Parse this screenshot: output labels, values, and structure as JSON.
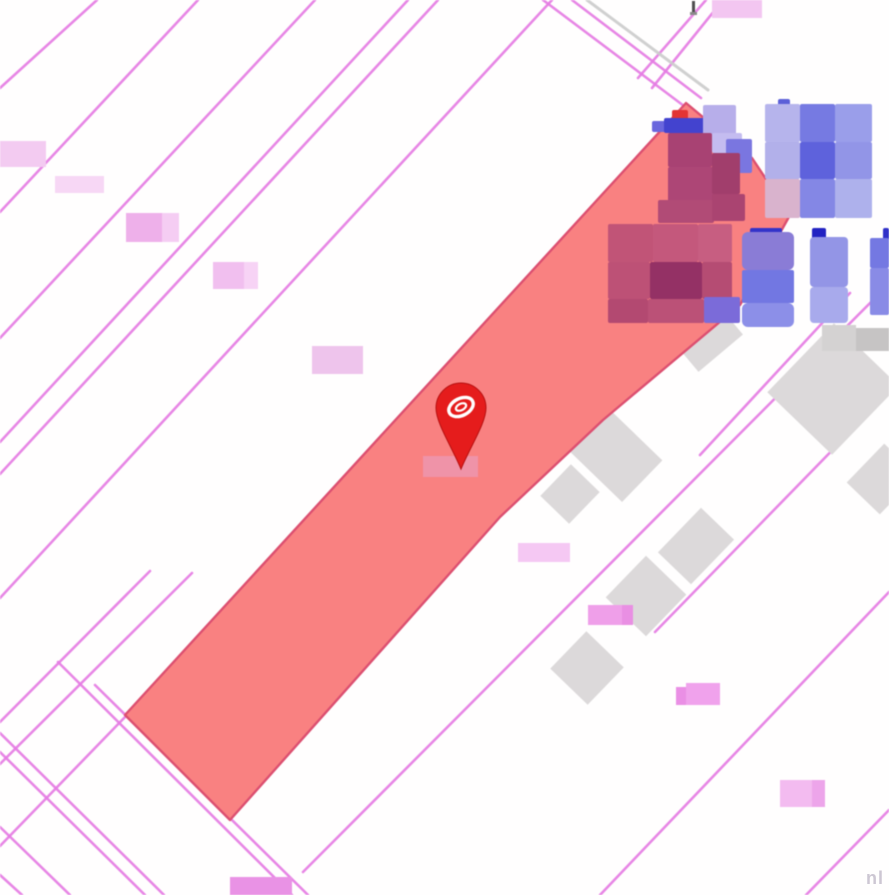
{
  "map": {
    "type": "cadastral-parcel-map",
    "watermark": "nl",
    "colors": {
      "background": "#ffffff",
      "boundary_line": "#e57ce3",
      "road_casing_gray": "#cccccc",
      "parcel_fill": "#f98181",
      "parcel_stroke": "#dc4f70",
      "building_gray": "#dcd9da",
      "marker_red": "#e51c1c",
      "marker_dark_red": "#b61010",
      "marker_logo": "#ffffff",
      "glyph_dark": "#4f4f4f"
    },
    "boundary_lines": [
      {
        "x1": 0,
        "y1": 88,
        "x2": 97,
        "y2": 0
      },
      {
        "x1": 0,
        "y1": 212,
        "x2": 198,
        "y2": 0
      },
      {
        "x1": 0,
        "y1": 338,
        "x2": 315,
        "y2": 0
      },
      {
        "x1": 0,
        "y1": 442,
        "x2": 408,
        "y2": 0
      },
      {
        "x1": 0,
        "y1": 474,
        "x2": 438,
        "y2": 0
      },
      {
        "x1": 0,
        "y1": 598,
        "x2": 552,
        "y2": 0
      },
      {
        "x1": 638,
        "y1": 78,
        "x2": 706,
        "y2": 0
      },
      {
        "x1": 652,
        "y1": 88,
        "x2": 723,
        "y2": 0
      },
      {
        "x1": 0,
        "y1": 722,
        "x2": 150,
        "y2": 571
      },
      {
        "x1": 0,
        "y1": 764,
        "x2": 192,
        "y2": 573
      },
      {
        "x1": 0,
        "y1": 846,
        "x2": 126,
        "y2": 716
      },
      {
        "x1": 700,
        "y1": 455,
        "x2": 850,
        "y2": 293
      },
      {
        "x1": 655,
        "y1": 632,
        "x2": 889,
        "y2": 392
      },
      {
        "x1": 303,
        "y1": 872,
        "x2": 889,
        "y2": 284
      },
      {
        "x1": 600,
        "y1": 895,
        "x2": 889,
        "y2": 592
      },
      {
        "x1": 806,
        "y1": 895,
        "x2": 889,
        "y2": 810
      },
      {
        "x1": 58,
        "y1": 662,
        "x2": 292,
        "y2": 895
      },
      {
        "x1": 95,
        "y1": 685,
        "x2": 308,
        "y2": 895
      },
      {
        "x1": 0,
        "y1": 733,
        "x2": 164,
        "y2": 895
      },
      {
        "x1": 0,
        "y1": 752,
        "x2": 145,
        "y2": 895
      },
      {
        "x1": 0,
        "y1": 827,
        "x2": 70,
        "y2": 895
      },
      {
        "x1": 0,
        "y1": 875,
        "x2": 22,
        "y2": 895
      },
      {
        "x1": 543,
        "y1": 0,
        "x2": 684,
        "y2": 106
      },
      {
        "x1": 572,
        "y1": 0,
        "x2": 701,
        "y2": 98
      },
      {
        "x1": 587,
        "y1": 0,
        "x2": 708,
        "y2": 90,
        "color": "#cccccc",
        "width": 3
      }
    ],
    "highlighted_parcel": {
      "points": [
        [
          686,
          103
        ],
        [
          752,
          158
        ],
        [
          790,
          215
        ],
        [
          740,
          305
        ],
        [
          603,
          420
        ],
        [
          500,
          517
        ],
        [
          230,
          820
        ],
        [
          125,
          715
        ]
      ]
    },
    "gray_buildings": [
      {
        "cx": 612,
        "cy": 452,
        "w": 58,
        "h": 84,
        "a": -46
      },
      {
        "cx": 570,
        "cy": 494,
        "w": 44,
        "h": 40,
        "a": -46
      },
      {
        "cx": 696,
        "cy": 546,
        "w": 62,
        "h": 46,
        "a": -46
      },
      {
        "cx": 646,
        "cy": 596,
        "w": 58,
        "h": 56,
        "a": -46
      },
      {
        "cx": 587,
        "cy": 668,
        "w": 52,
        "h": 52,
        "a": -46
      },
      {
        "cx": 833,
        "cy": 389,
        "w": 96,
        "h": 90,
        "a": -46
      },
      {
        "cx": 882,
        "cy": 479,
        "w": 54,
        "h": 46,
        "a": -46
      },
      {
        "cx": 630,
        "cy": 357,
        "w": 48,
        "h": 26,
        "a": -46
      },
      {
        "cx": 713,
        "cy": 344,
        "w": 58,
        "h": 24,
        "a": -40
      }
    ],
    "blurred_labels": [
      {
        "x": 822,
        "y": 325,
        "w": 34,
        "h": 26,
        "color": "#d4d2d2"
      },
      {
        "x": 856,
        "y": 328,
        "w": 33,
        "h": 23,
        "color": "#c6c4c4"
      },
      {
        "x": 0,
        "y": 141,
        "w": 46,
        "h": 26,
        "color": "#f3cbf1"
      },
      {
        "x": 55,
        "y": 176,
        "w": 49,
        "h": 17,
        "color": "#f7d7f5"
      },
      {
        "x": 126,
        "y": 213,
        "w": 36,
        "h": 29,
        "color": "#eeb0ea"
      },
      {
        "x": 162,
        "y": 213,
        "w": 17,
        "h": 29,
        "color": "#f5cdf3"
      },
      {
        "x": 213,
        "y": 262,
        "w": 31,
        "h": 27,
        "color": "#f1bfef"
      },
      {
        "x": 244,
        "y": 262,
        "w": 14,
        "h": 27,
        "color": "#f7d3f5"
      },
      {
        "x": 312,
        "y": 346,
        "w": 51,
        "h": 28,
        "color": "#eec4ec"
      },
      {
        "x": 518,
        "y": 543,
        "w": 52,
        "h": 19,
        "color": "#f5c8f3"
      },
      {
        "x": 588,
        "y": 605,
        "w": 34,
        "h": 20,
        "color": "#ef9fe9"
      },
      {
        "x": 622,
        "y": 605,
        "w": 11,
        "h": 20,
        "color": "#e98fe3"
      },
      {
        "x": 676,
        "y": 687,
        "w": 10,
        "h": 18,
        "color": "#ea8fe5"
      },
      {
        "x": 686,
        "y": 683,
        "w": 34,
        "h": 22,
        "color": "#f0a2ec"
      },
      {
        "x": 780,
        "y": 780,
        "w": 32,
        "h": 27,
        "color": "#f3bbf0"
      },
      {
        "x": 812,
        "y": 780,
        "w": 13,
        "h": 27,
        "color": "#eda5ea"
      },
      {
        "x": 712,
        "y": 0,
        "w": 50,
        "h": 18,
        "color": "#f3c6f1"
      },
      {
        "x": 230,
        "y": 877,
        "w": 62,
        "h": 18,
        "color": "#e992e5"
      },
      {
        "x": 423,
        "y": 456,
        "w": 55,
        "h": 21,
        "color": "#ef93a8"
      }
    ],
    "blurred_buildings": [
      {
        "x": 672,
        "y": 110,
        "w": 16,
        "h": 14,
        "color": "#e23434"
      },
      {
        "x": 652,
        "y": 121,
        "w": 14,
        "h": 11,
        "color": "#6a66dd"
      },
      {
        "x": 664,
        "y": 118,
        "w": 40,
        "h": 15,
        "color": "#4343cf"
      },
      {
        "x": 703,
        "y": 105,
        "w": 33,
        "h": 30,
        "color": "#b7aeea"
      },
      {
        "x": 712,
        "y": 133,
        "w": 30,
        "h": 20,
        "color": "#c4bcf0"
      },
      {
        "x": 726,
        "y": 139,
        "w": 26,
        "h": 34,
        "color": "#7a76e0"
      },
      {
        "x": 668,
        "y": 133,
        "w": 44,
        "h": 34,
        "color": "#a84273"
      },
      {
        "x": 668,
        "y": 167,
        "w": 46,
        "h": 35,
        "color": "#ad4676"
      },
      {
        "x": 712,
        "y": 153,
        "w": 28,
        "h": 41,
        "color": "#a13e6c"
      },
      {
        "x": 658,
        "y": 200,
        "w": 56,
        "h": 23,
        "color": "#b14b76"
      },
      {
        "x": 712,
        "y": 194,
        "w": 33,
        "h": 27,
        "color": "#aa4471"
      },
      {
        "x": 778,
        "y": 99,
        "w": 12,
        "h": 8,
        "color": "#5b5fd8"
      },
      {
        "x": 765,
        "y": 104,
        "w": 35,
        "h": 38,
        "color": "#b6b4ec"
      },
      {
        "x": 800,
        "y": 104,
        "w": 35,
        "h": 38,
        "color": "#767ae2"
      },
      {
        "x": 835,
        "y": 104,
        "w": 37,
        "h": 38,
        "color": "#9a9eea"
      },
      {
        "x": 765,
        "y": 142,
        "w": 35,
        "h": 37,
        "color": "#b2b0ea"
      },
      {
        "x": 800,
        "y": 142,
        "w": 35,
        "h": 37,
        "color": "#5e62dc"
      },
      {
        "x": 835,
        "y": 142,
        "w": 37,
        "h": 37,
        "color": "#9295e7"
      },
      {
        "x": 765,
        "y": 179,
        "w": 35,
        "h": 39,
        "color": "#d9b3cd"
      },
      {
        "x": 800,
        "y": 179,
        "w": 35,
        "h": 39,
        "color": "#8487e5"
      },
      {
        "x": 835,
        "y": 179,
        "w": 37,
        "h": 39,
        "color": "#aeb1ec"
      },
      {
        "x": 608,
        "y": 224,
        "w": 45,
        "h": 38,
        "color": "#c15477"
      },
      {
        "x": 653,
        "y": 224,
        "w": 45,
        "h": 38,
        "color": "#c4587c"
      },
      {
        "x": 698,
        "y": 224,
        "w": 34,
        "h": 38,
        "color": "#c75e81"
      },
      {
        "x": 608,
        "y": 262,
        "w": 42,
        "h": 37,
        "color": "#bd5176"
      },
      {
        "x": 650,
        "y": 262,
        "w": 52,
        "h": 37,
        "color": "#943165"
      },
      {
        "x": 702,
        "y": 262,
        "w": 30,
        "h": 37,
        "color": "#b54c73"
      },
      {
        "x": 608,
        "y": 299,
        "w": 40,
        "h": 24,
        "color": "#b34971"
      },
      {
        "x": 648,
        "y": 299,
        "w": 56,
        "h": 24,
        "color": "#bb5177"
      },
      {
        "x": 704,
        "y": 297,
        "w": 36,
        "h": 26,
        "color": "#7b6bd9"
      },
      {
        "x": 750,
        "y": 228,
        "w": 32,
        "h": 10,
        "color": "#3333c9"
      },
      {
        "x": 742,
        "y": 232,
        "w": 52,
        "h": 38,
        "color": "#8a7cd6",
        "r": 6
      },
      {
        "x": 742,
        "y": 270,
        "w": 52,
        "h": 33,
        "color": "#7277e2"
      },
      {
        "x": 742,
        "y": 303,
        "w": 52,
        "h": 24,
        "color": "#8c8fe8",
        "r": 6
      },
      {
        "x": 812,
        "y": 228,
        "w": 14,
        "h": 11,
        "color": "#2222c2"
      },
      {
        "x": 810,
        "y": 237,
        "w": 38,
        "h": 50,
        "color": "#9395e6",
        "r": 4
      },
      {
        "x": 810,
        "y": 287,
        "w": 38,
        "h": 36,
        "color": "#a8aaec",
        "r": 4
      },
      {
        "x": 883,
        "y": 228,
        "w": 6,
        "h": 13,
        "color": "#3030c8"
      },
      {
        "x": 870,
        "y": 238,
        "w": 19,
        "h": 30,
        "color": "#7478e2"
      },
      {
        "x": 870,
        "y": 268,
        "w": 19,
        "h": 47,
        "color": "#898be6"
      }
    ],
    "marker": {
      "x": 461,
      "tip_y": 469,
      "bulb_cy": 408,
      "r": 25
    },
    "top_glyph": {
      "x": 692,
      "y": 1
    }
  }
}
